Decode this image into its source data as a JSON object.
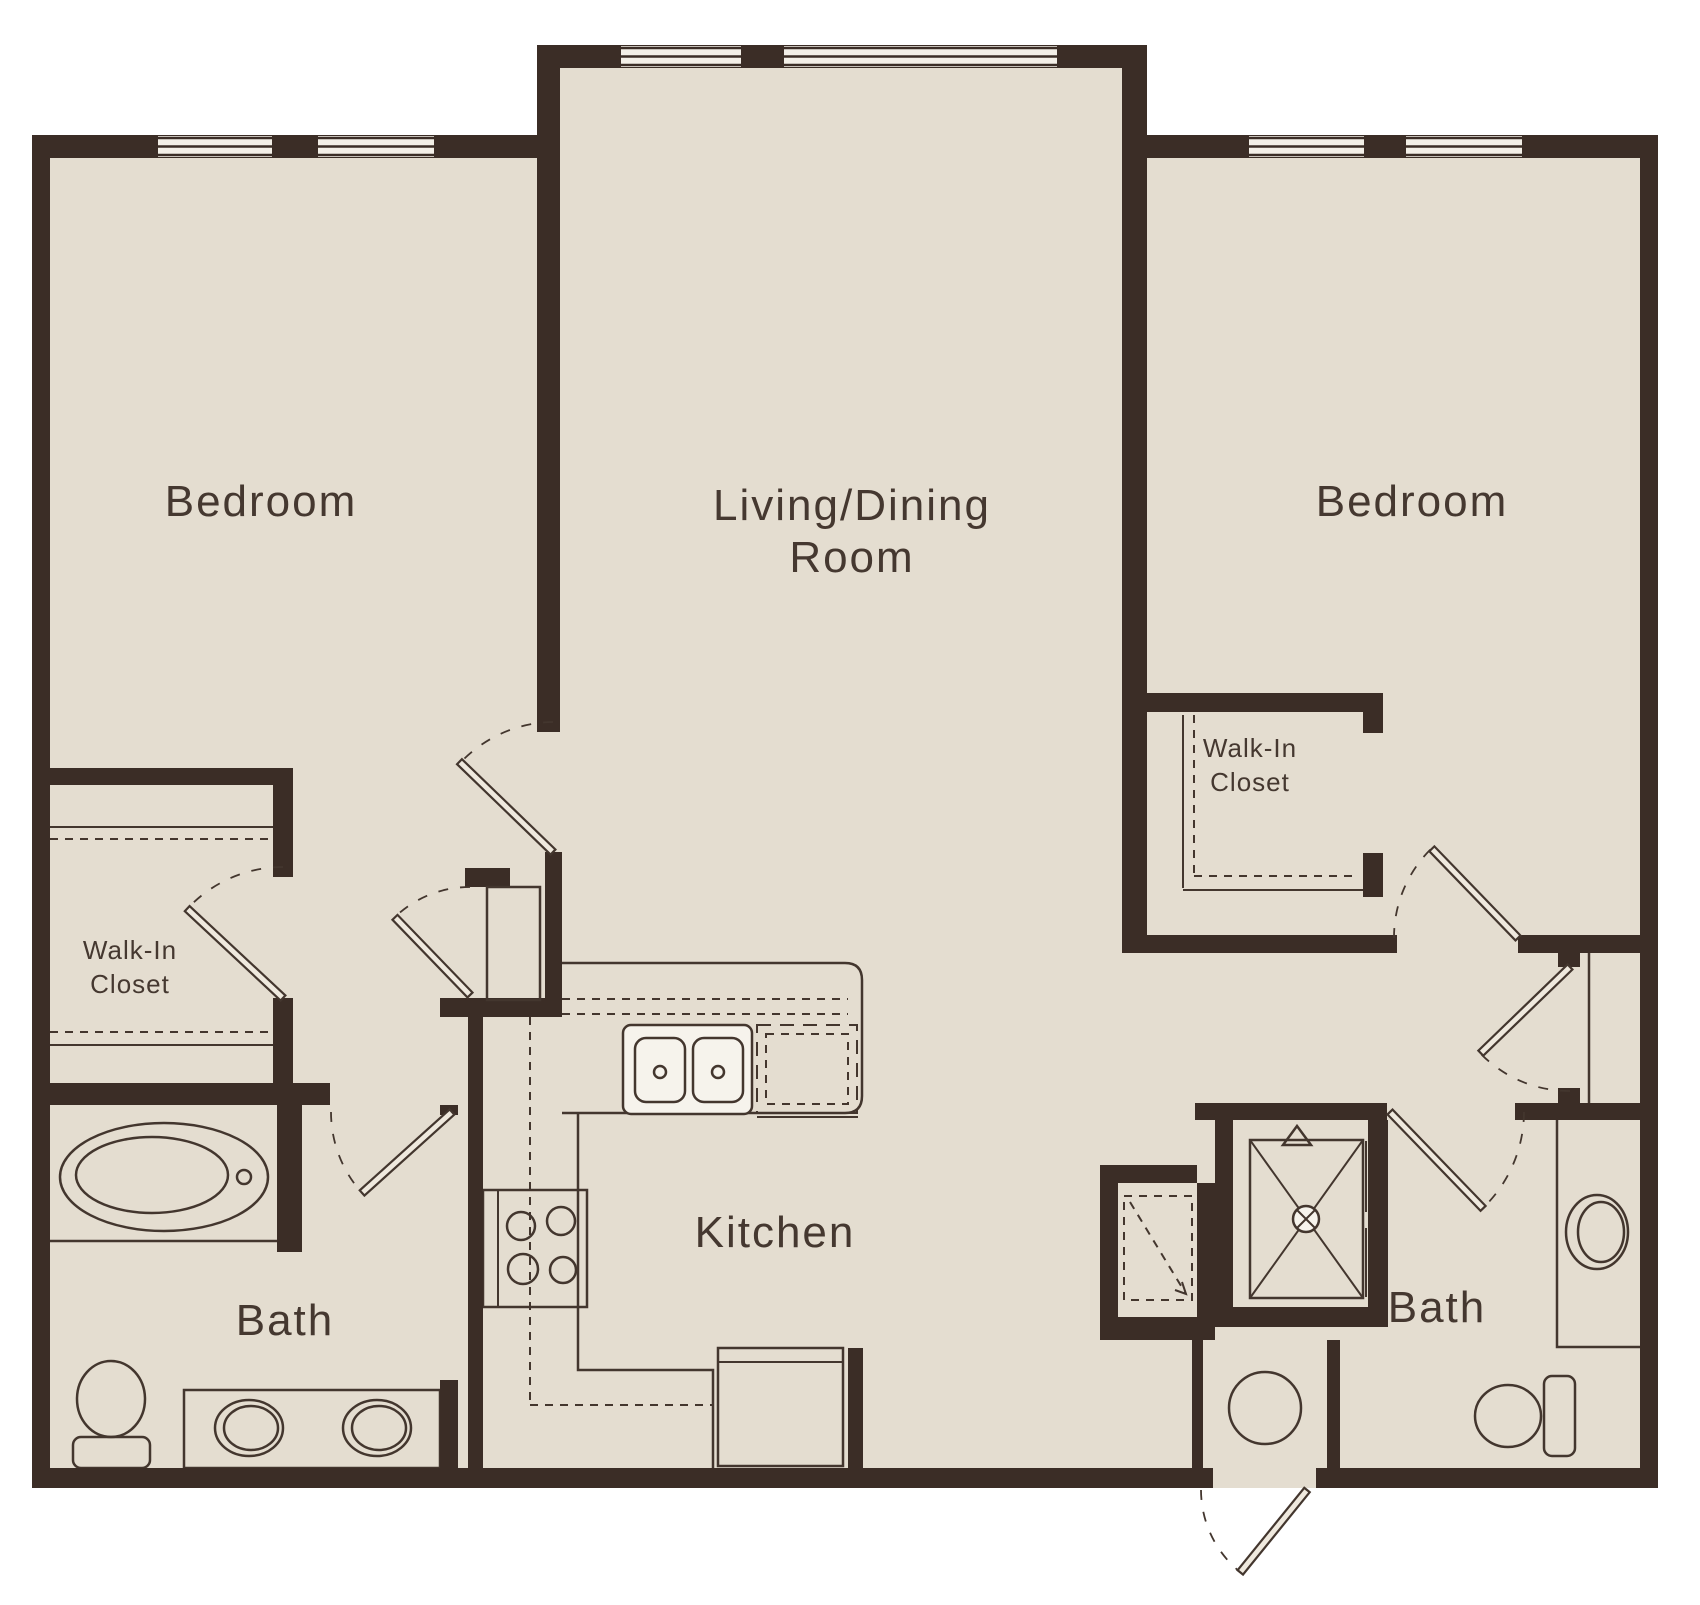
{
  "plan": {
    "type": "apartment-floor-plan",
    "rooms": {
      "bedroom_left": {
        "label": "Bedroom"
      },
      "living": {
        "label_line1": "Living/Dining",
        "label_line2": "Room"
      },
      "bedroom_right": {
        "label": "Bedroom"
      },
      "walkin_left": {
        "label_line1": "Walk-In",
        "label_line2": "Closet"
      },
      "walkin_right": {
        "label_line1": "Walk-In",
        "label_line2": "Closet"
      },
      "kitchen": {
        "label": "Kitchen"
      },
      "bath_left": {
        "label": "Bath"
      },
      "bath_right": {
        "label": "Bath"
      }
    },
    "fixture_icons": [
      "bathtub-icon",
      "toilet-icon",
      "double-vanity-sink-icon",
      "vanity-sink-icon",
      "kitchen-sink-icon",
      "stove-icon",
      "refrigerator-icon",
      "dishwasher-icon",
      "shower-icon",
      "washer-icon",
      "closet-shelf-lines",
      "door-swing-arc"
    ],
    "palette": {
      "wall": "#3b2d26",
      "floor": "#e4ddd0",
      "line": "#43362e",
      "background": "#ffffff"
    }
  }
}
